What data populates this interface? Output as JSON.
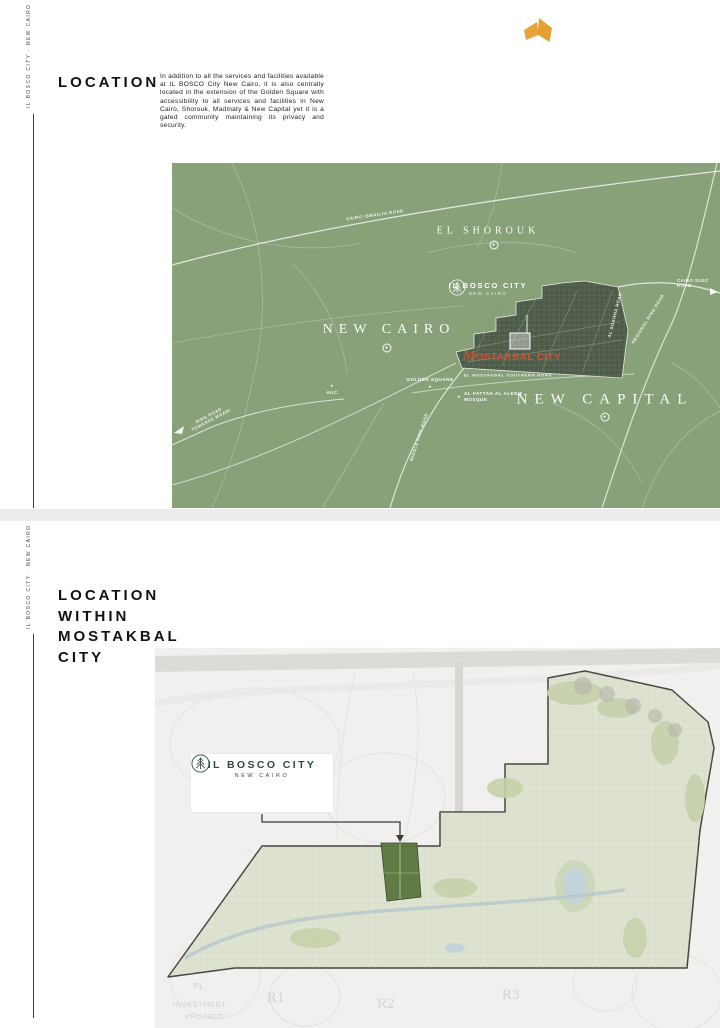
{
  "brand": {
    "vertical_text": "IL BOSCO CITY · NEW CAIRO",
    "logo_color": "#E8A33B",
    "brand_green": "#2D4A3A"
  },
  "section1": {
    "heading": "LOCATION",
    "paragraph": "In addition to all the services and facilities available at IL BOSCO City New Cairo, it is also centrally located in the extension of the Golden Square with accessibility to all services and facilities in New Cairo, Shorouk, Madinaty & New Capital yet it is a gated community maintaining its privacy and security.",
    "map": {
      "bg_color": "#88A178",
      "accent_color": "#D5512E",
      "labels": {
        "cairo_ismailya_road": "CAIRO ISMAILYA ROAD",
        "el_shorouk": "EL SHOROUK",
        "bosco_title": "IL BOSCO CITY",
        "bosco_subtitle": "NEW CAIRO",
        "new_cairo": "NEW CAIRO",
        "mostakbal_city": "MOSTAKBAL CITY",
        "southern_road": "EL MOSTAKBAL SOUTHERN ROAD",
        "golden_square": "GOLDEN SQUARE",
        "auc": "AUC",
        "mosque_line1": "AL FATTAH AL ALEEM",
        "mosque_line2": "MOSQUE",
        "new_capital": "NEW CAPITAL",
        "ring_road_maadi": "RING ROAD TOWARDS MAADI",
        "middle_ring_road": "MIDDLE RING ROAD",
        "regional_ring_road": "REGIONAL RING ROAD",
        "sokhna_road": "AL SOKHNA ROAD",
        "suez_line1": "CAIRO SUEZ",
        "suez_line2": "ROAD"
      }
    }
  },
  "section2": {
    "heading": [
      "LOCATION",
      "WITHIN",
      "MOSTAKBAL",
      "CITY"
    ],
    "map": {
      "card": {
        "title": "IL BOSCO CITY",
        "subtitle": "NEW CAIRO"
      },
      "background_labels": {
        "p1": "P1",
        "investment": "INVESTMENT",
        "project": "PROJECT",
        "r1": "R1",
        "r2": "R2",
        "r3": "R3"
      }
    }
  }
}
